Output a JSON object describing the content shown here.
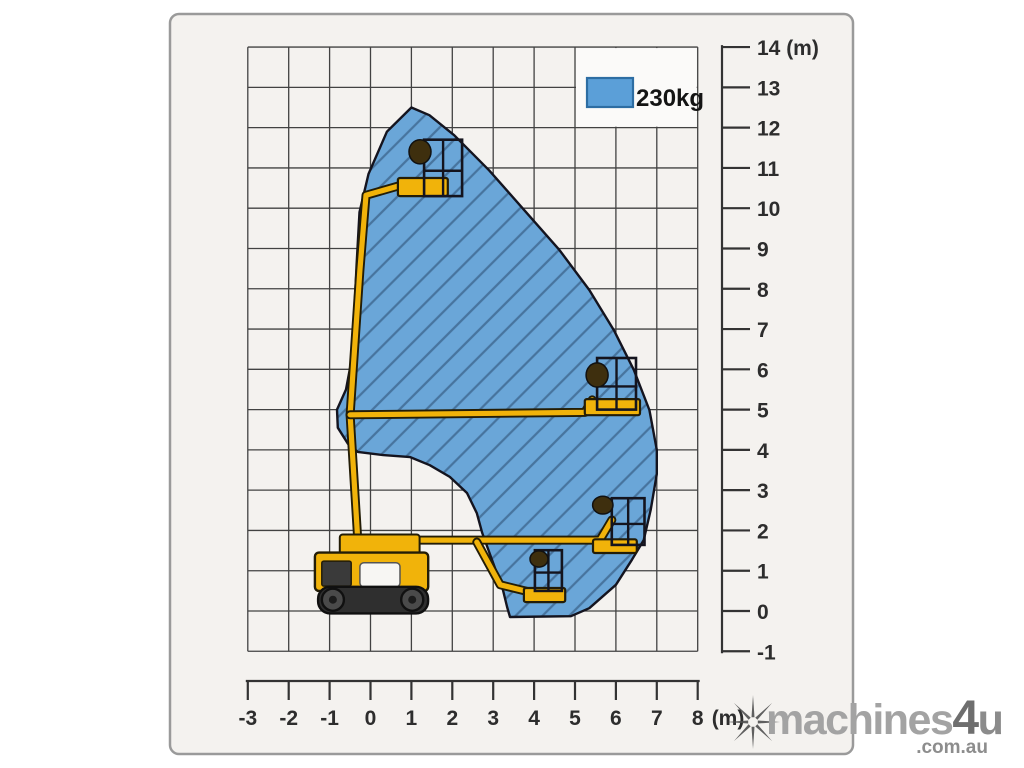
{
  "panel": {
    "fill": "#f4f2ef",
    "border_color": "#9a9a9a",
    "legend_patch_fill": "#fbfaf9"
  },
  "grid": {
    "line_color": "#424242",
    "on": true
  },
  "legend": {
    "label": "230kg",
    "swatch_fill": "#5b9fd8",
    "swatch_border": "#2d6da3",
    "position": "top-right"
  },
  "axes": {
    "x": {
      "min": -3,
      "max": 8,
      "unit": "(m)",
      "ticks": [
        -3,
        -2,
        -1,
        0,
        1,
        2,
        3,
        4,
        5,
        6,
        7,
        8
      ],
      "tick_labels": [
        "-3",
        "-2",
        "-1",
        "0",
        "1",
        "2",
        "3",
        "4",
        "5",
        "6",
        "7",
        "8"
      ]
    },
    "y": {
      "min": -1,
      "max": 14,
      "unit": "(m)",
      "ticks": [
        14,
        13,
        12,
        11,
        10,
        9,
        8,
        7,
        6,
        5,
        4,
        3,
        2,
        1,
        0,
        -1
      ],
      "tick_labels": [
        "14 (m)",
        "13",
        "12",
        "11",
        "10",
        "9",
        "8",
        "7",
        "6",
        "5",
        "4",
        "3",
        "2",
        "1",
        "0",
        "-1"
      ]
    }
  },
  "chart_data": {
    "type": "area",
    "title": "",
    "xlabel": "(m)",
    "ylabel": "(m)",
    "xlim": [
      -3,
      8
    ],
    "ylim": [
      -1,
      14
    ],
    "grid": true,
    "legend": {
      "position": "top-right",
      "entries": [
        {
          "label": "230kg",
          "color": "#5b9fd8"
        }
      ]
    },
    "series": [
      {
        "name": "230kg working envelope",
        "fill": "#6aa6d8",
        "hatch_color": "#47749e",
        "outline": "#14141f",
        "points": [
          [
            1.0,
            12.5
          ],
          [
            1.44,
            12.31
          ],
          [
            2.05,
            11.81
          ],
          [
            2.9,
            10.94
          ],
          [
            3.76,
            9.95
          ],
          [
            4.62,
            8.96
          ],
          [
            5.35,
            7.97
          ],
          [
            5.95,
            6.97
          ],
          [
            6.44,
            5.98
          ],
          [
            6.82,
            4.99
          ],
          [
            7.0,
            4.0
          ],
          [
            7.0,
            3.4
          ],
          [
            6.85,
            2.51
          ],
          [
            6.68,
            1.76
          ],
          [
            6.39,
            1.27
          ],
          [
            6.0,
            0.65
          ],
          [
            5.35,
            0.07
          ],
          [
            4.9,
            -0.13
          ],
          [
            3.41,
            -0.15
          ],
          [
            3.34,
            0.1
          ],
          [
            3.24,
            0.52
          ],
          [
            3.0,
            1.19
          ],
          [
            2.73,
            1.94
          ],
          [
            2.6,
            2.43
          ],
          [
            2.36,
            2.93
          ],
          [
            1.94,
            3.33
          ],
          [
            1.45,
            3.62
          ],
          [
            0.97,
            3.82
          ],
          [
            0.31,
            3.87
          ],
          [
            -0.31,
            3.95
          ],
          [
            -0.55,
            4.15
          ],
          [
            -0.8,
            4.55
          ],
          [
            -0.82,
            5.0
          ],
          [
            -0.6,
            5.5
          ],
          [
            -0.47,
            6.2
          ],
          [
            -0.4,
            7.3
          ],
          [
            -0.34,
            8.6
          ],
          [
            -0.27,
            9.9
          ],
          [
            -0.05,
            10.85
          ],
          [
            0.4,
            11.9
          ]
        ]
      }
    ],
    "annotations": [
      "tracked boom lift illustrated at four boom positions inside the envelope"
    ]
  },
  "machine": {
    "color": "#f1b30a",
    "outline": "#231d07",
    "frame_color": "#14141e",
    "track_color": "#2f2f2f",
    "wheel_color": "#4a4a4a",
    "head_color": "#3e2f0e",
    "base": {
      "tracks": {
        "x": -1.28,
        "y": -0.06,
        "w": 2.69,
        "h": 0.66
      },
      "wheels": [
        {
          "cx": -0.92,
          "cy": 0.28,
          "r": 0.27
        },
        {
          "cx": 1.02,
          "cy": 0.28,
          "r": 0.27
        }
      ],
      "body": {
        "x": -1.36,
        "y": 0.5,
        "w": 2.77,
        "h": 0.95
      },
      "cab_window": {
        "x": -1.19,
        "y": 0.62,
        "w": 0.72,
        "h": 0.62
      },
      "body_panel": {
        "x": -0.26,
        "y": 0.6,
        "w": 0.98,
        "h": 0.6
      },
      "turret": {
        "x": -0.75,
        "y": 1.4,
        "w": 1.95,
        "h": 0.5
      }
    },
    "poses": [
      {
        "name": "raised",
        "boom": [
          [
            -0.31,
            1.75
          ],
          [
            -0.5,
            4.87
          ],
          [
            -0.26,
            8.46
          ],
          [
            -0.11,
            10.32
          ],
          [
            0.92,
            10.62
          ]
        ],
        "platform": {
          "x": 0.67,
          "y": 10.3,
          "w": 1.22,
          "h": 0.45
        },
        "basket": {
          "x": 1.31,
          "y": 10.3,
          "w": 0.93,
          "h": 1.4
        },
        "head": {
          "cx": 1.21,
          "cy": 11.4,
          "rx": 0.27,
          "ry": 0.3
        }
      },
      {
        "name": "horizontal",
        "boom": [
          [
            -0.5,
            4.87
          ],
          [
            5.24,
            4.93
          ],
          [
            5.42,
            5.24
          ]
        ],
        "platform": {
          "x": 5.24,
          "y": 4.86,
          "w": 1.35,
          "h": 0.4
        },
        "basket": {
          "x": 5.54,
          "y": 5.0,
          "w": 0.95,
          "h": 1.28
        },
        "head": {
          "cx": 5.54,
          "cy": 5.86,
          "rx": 0.27,
          "ry": 0.3
        }
      },
      {
        "name": "low-right",
        "boom": [
          [
            0.84,
            1.76
          ],
          [
            5.61,
            1.76
          ],
          [
            5.9,
            2.26
          ]
        ],
        "platform": {
          "x": 5.44,
          "y": 1.44,
          "w": 1.07,
          "h": 0.34
        },
        "basket": {
          "x": 5.9,
          "y": 1.64,
          "w": 0.8,
          "h": 1.16
        },
        "head": {
          "cx": 5.68,
          "cy": 2.63,
          "rx": 0.25,
          "ry": 0.22
        }
      },
      {
        "name": "lowest",
        "boom": [
          [
            2.6,
            1.71
          ],
          [
            3.17,
            0.65
          ],
          [
            3.9,
            0.47
          ]
        ],
        "platform": {
          "x": 3.75,
          "y": 0.22,
          "w": 1.01,
          "h": 0.35
        },
        "basket": {
          "x": 4.02,
          "y": 0.5,
          "w": 0.66,
          "h": 1.01
        },
        "head": {
          "cx": 4.12,
          "cy": 1.29,
          "rx": 0.22,
          "ry": 0.2
        }
      }
    ]
  },
  "watermark": {
    "icon": "eight-spoke-star",
    "icon_color": "#4f4f4f",
    "brand": "machines",
    "brand_accent": "4",
    "brand_accent2": "u",
    "suffix": ".com.au",
    "brand_color": "#a3a3a3",
    "accent_color": "#6e6e6e",
    "accent2_color": "#8b8b8b",
    "suffix_color": "#8d8d8d"
  }
}
